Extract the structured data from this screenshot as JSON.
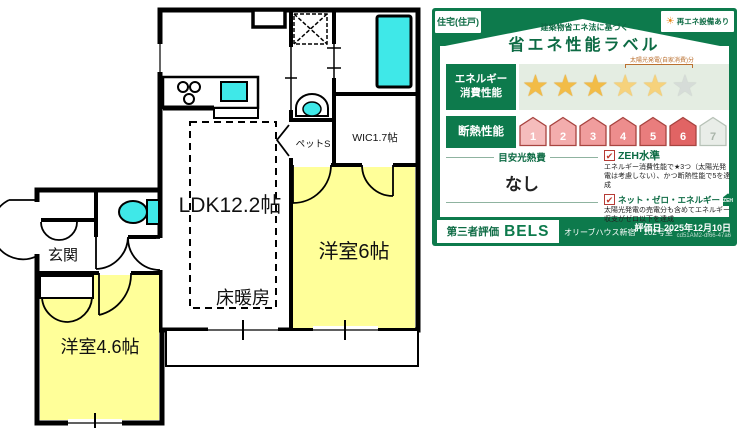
{
  "floor_plan": {
    "labels": {
      "ldk": "LDK12.2帖",
      "floor_heating": "床暖房",
      "bedroom_6": "洋室6帖",
      "bedroom_46": "洋室4.6帖",
      "entrance": "玄関",
      "pet_space": "ペットS",
      "wic": "WIC1.7帖"
    },
    "colors": {
      "room_fill": "#FFFF99",
      "fixture_fill": "#3FE8E8",
      "wall": "#000000"
    }
  },
  "energy_label": {
    "type_badge": "住宅(住戸)",
    "renewable_badge": "再エネ設備あり",
    "sun_icon": "☀",
    "title_small": "建築物省エネ法に基づく",
    "title_main": "省エネ性能ラベル",
    "energy": {
      "label_line1": "エネルギー",
      "label_line2": "消費性能",
      "star_icon": "★",
      "stars_filled": 3,
      "stars_solar": 2,
      "stars_empty": 1,
      "solar_note": "太陽光発電(自家消費)分"
    },
    "insulation": {
      "label": "断熱性能",
      "levels": [
        "1",
        "2",
        "3",
        "4",
        "5",
        "6",
        "7"
      ],
      "achieved_max": 6
    },
    "utility": {
      "label": "目安光熱費",
      "value": "なし"
    },
    "check_icon": "✔",
    "zeh": {
      "label": "ZEH水準",
      "desc": "エネルギー消費性能で★3つ（太陽光発電は考慮しない）、かつ断熱性能で5を達成"
    },
    "net_zero": {
      "label": "ネット・ゼロ・エネルギー",
      "badge": "ZEH",
      "desc": "太陽光発電の売電分も含めてエネルギー収支がゼロ以下を達成"
    },
    "footer": {
      "cert_label": "第三者評価",
      "cert_name": "BELS",
      "property_name": "オリーブハウス新宿　102号室",
      "eval_date": "評価日 2025年12月10日",
      "doc_id": "cd51AM2-df66-47a6"
    },
    "colors": {
      "card_green": "#0D7A4C",
      "text_green": "#0D6B44",
      "star_gold": "#F2BC47",
      "house_red": "#E26F6F"
    }
  }
}
